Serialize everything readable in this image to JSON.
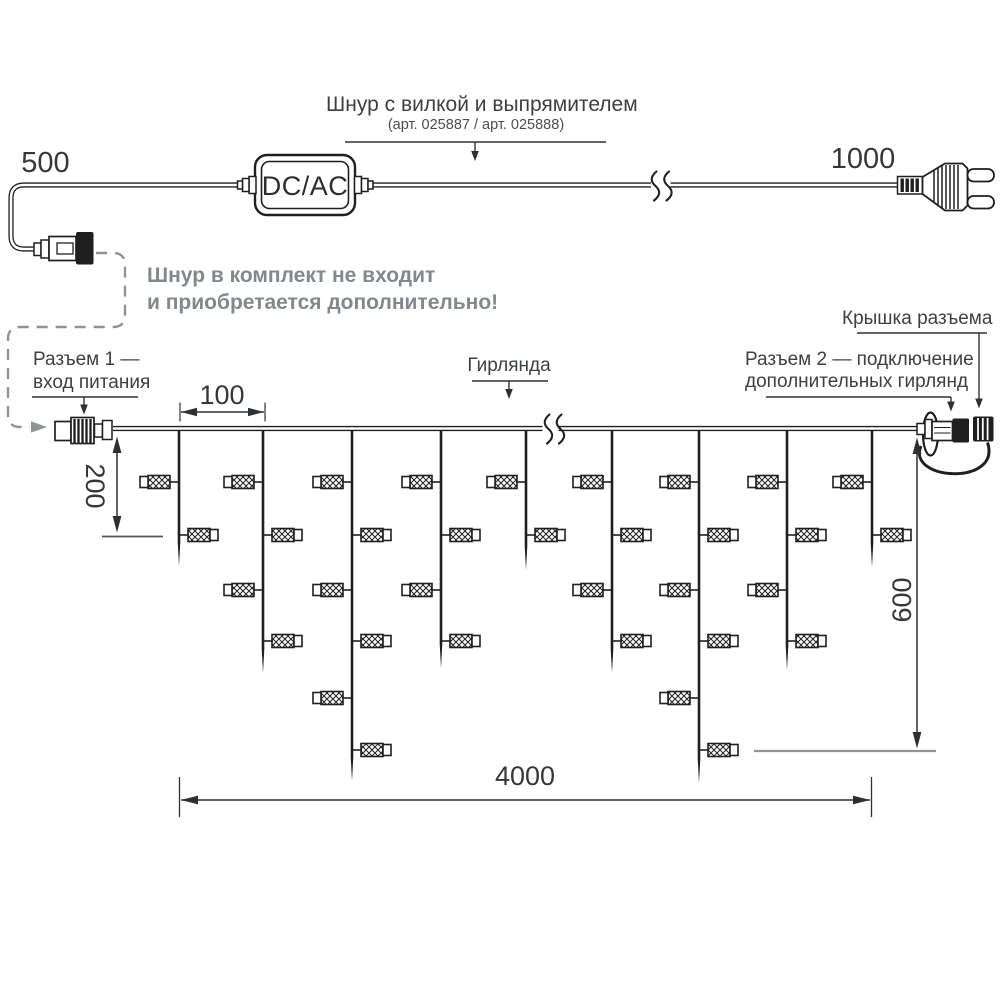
{
  "colors": {
    "line": "#1f1f1f",
    "dim": "#2e3134",
    "muted_gray": "#8f9296",
    "note_gray": "#83888d"
  },
  "power_cord": {
    "length_left_label": "500",
    "length_right_label": "1000",
    "converter_label": "DC/AC",
    "callout_title": "Шнур с вилкой и выпрямителем",
    "callout_subtitle": "(арт. 025887 /  арт. 025888)",
    "note_line1": "Шнур в комплект не входит",
    "note_line2": "и приобретается дополнительно!"
  },
  "garland": {
    "label": "Гирлянда",
    "connector1_line1": "Разъем 1 —",
    "connector1_line2": "вход питания",
    "connector2_line1": "Разъем 2 — подключение",
    "connector2_line2": "дополнительных гирлянд",
    "cap_label": "Крышка разъема",
    "dim_drop_spacing": "100",
    "dim_short_drop": "200",
    "dim_long_drop": "600",
    "dim_total_length": "4000"
  },
  "garland_geometry": {
    "wire_y": 430,
    "wire_x1": 113,
    "wire_x2": 917,
    "lamp_levels_y": [
      482,
      535,
      590,
      641,
      698,
      750
    ],
    "drops": [
      {
        "x": 179,
        "lamps": 2,
        "tip_y": 566
      },
      {
        "x": 263,
        "lamps": 4,
        "tip_y": 673
      },
      {
        "x": 352,
        "lamps": 6,
        "tip_y": 781
      },
      {
        "x": 441,
        "lamps": 4,
        "tip_y": 668
      },
      {
        "x": 526,
        "lamps": 2,
        "tip_y": 570
      },
      {
        "x": 612,
        "lamps": 4,
        "tip_y": 673
      },
      {
        "x": 699,
        "lamps": 6,
        "tip_y": 783
      },
      {
        "x": 787,
        "lamps": 4,
        "tip_y": 670
      },
      {
        "x": 872,
        "lamps": 2,
        "tip_y": 567
      }
    ]
  }
}
